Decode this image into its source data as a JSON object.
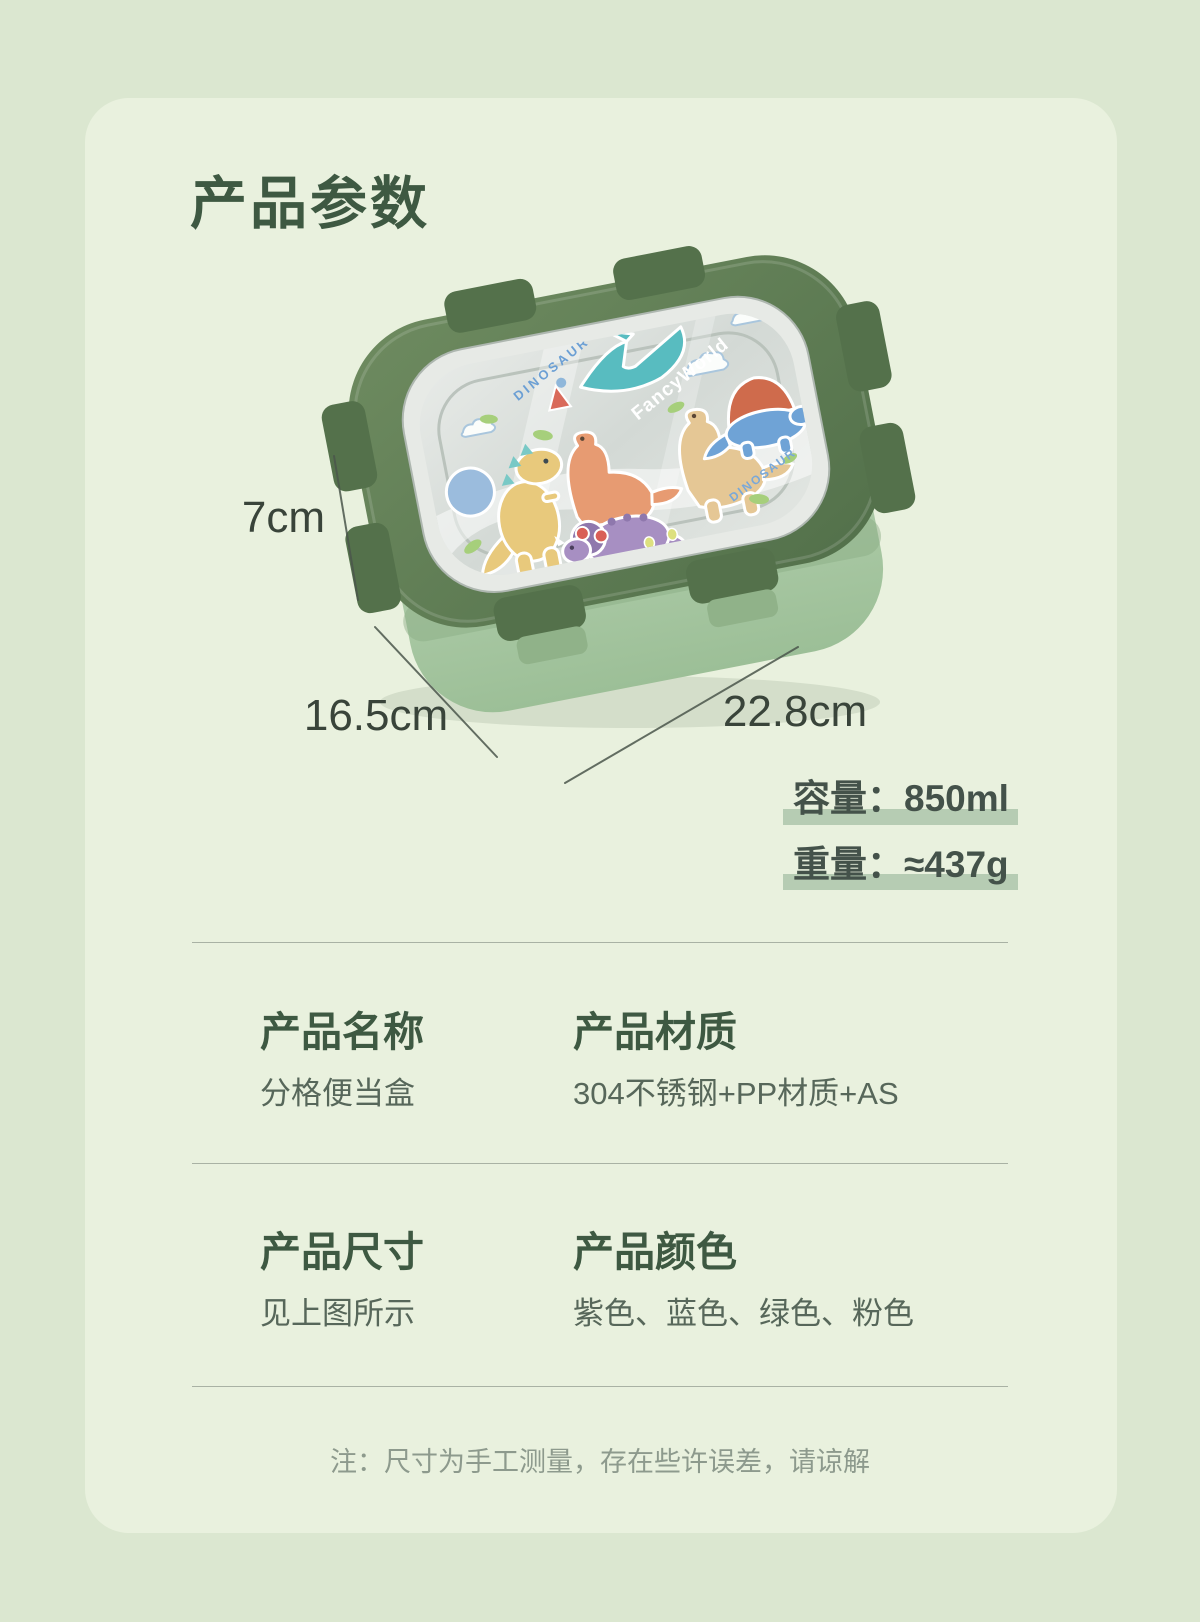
{
  "page": {
    "title": "产品参数"
  },
  "product": {
    "brand_text": "FancyWorld",
    "dinosaur_text_left": "DINOSAUR",
    "dinosaur_text_right": "DINOSAUR"
  },
  "dimensions": {
    "height": "7cm",
    "width": "16.5cm",
    "length": "22.8cm"
  },
  "metrics": [
    {
      "label": "容量：",
      "value": "850ml"
    },
    {
      "label": "重量：",
      "value": "≈437g"
    }
  ],
  "specs": {
    "rows": [
      {
        "cols": [
          {
            "h": "产品名称",
            "v": "分格便当盒"
          },
          {
            "h": "产品材质",
            "v": "304不锈钢+PP材质+AS"
          }
        ]
      },
      {
        "cols": [
          {
            "h": "产品尺寸",
            "v": "见上图所示"
          },
          {
            "h": "产品颜色",
            "v": "紫色、蓝色、绿色、粉色"
          }
        ]
      }
    ]
  },
  "note": "注：尺寸为手工测量，存在些许误差，请谅解",
  "colors": {
    "accent_dark_green": "#3e5942",
    "highlight_bar": "#b6ccb3",
    "lid_green": "#5b7a52",
    "body_green": "#a9c6a2",
    "page_background": "#dbe7d0",
    "panel_background": "#e9f1de"
  }
}
